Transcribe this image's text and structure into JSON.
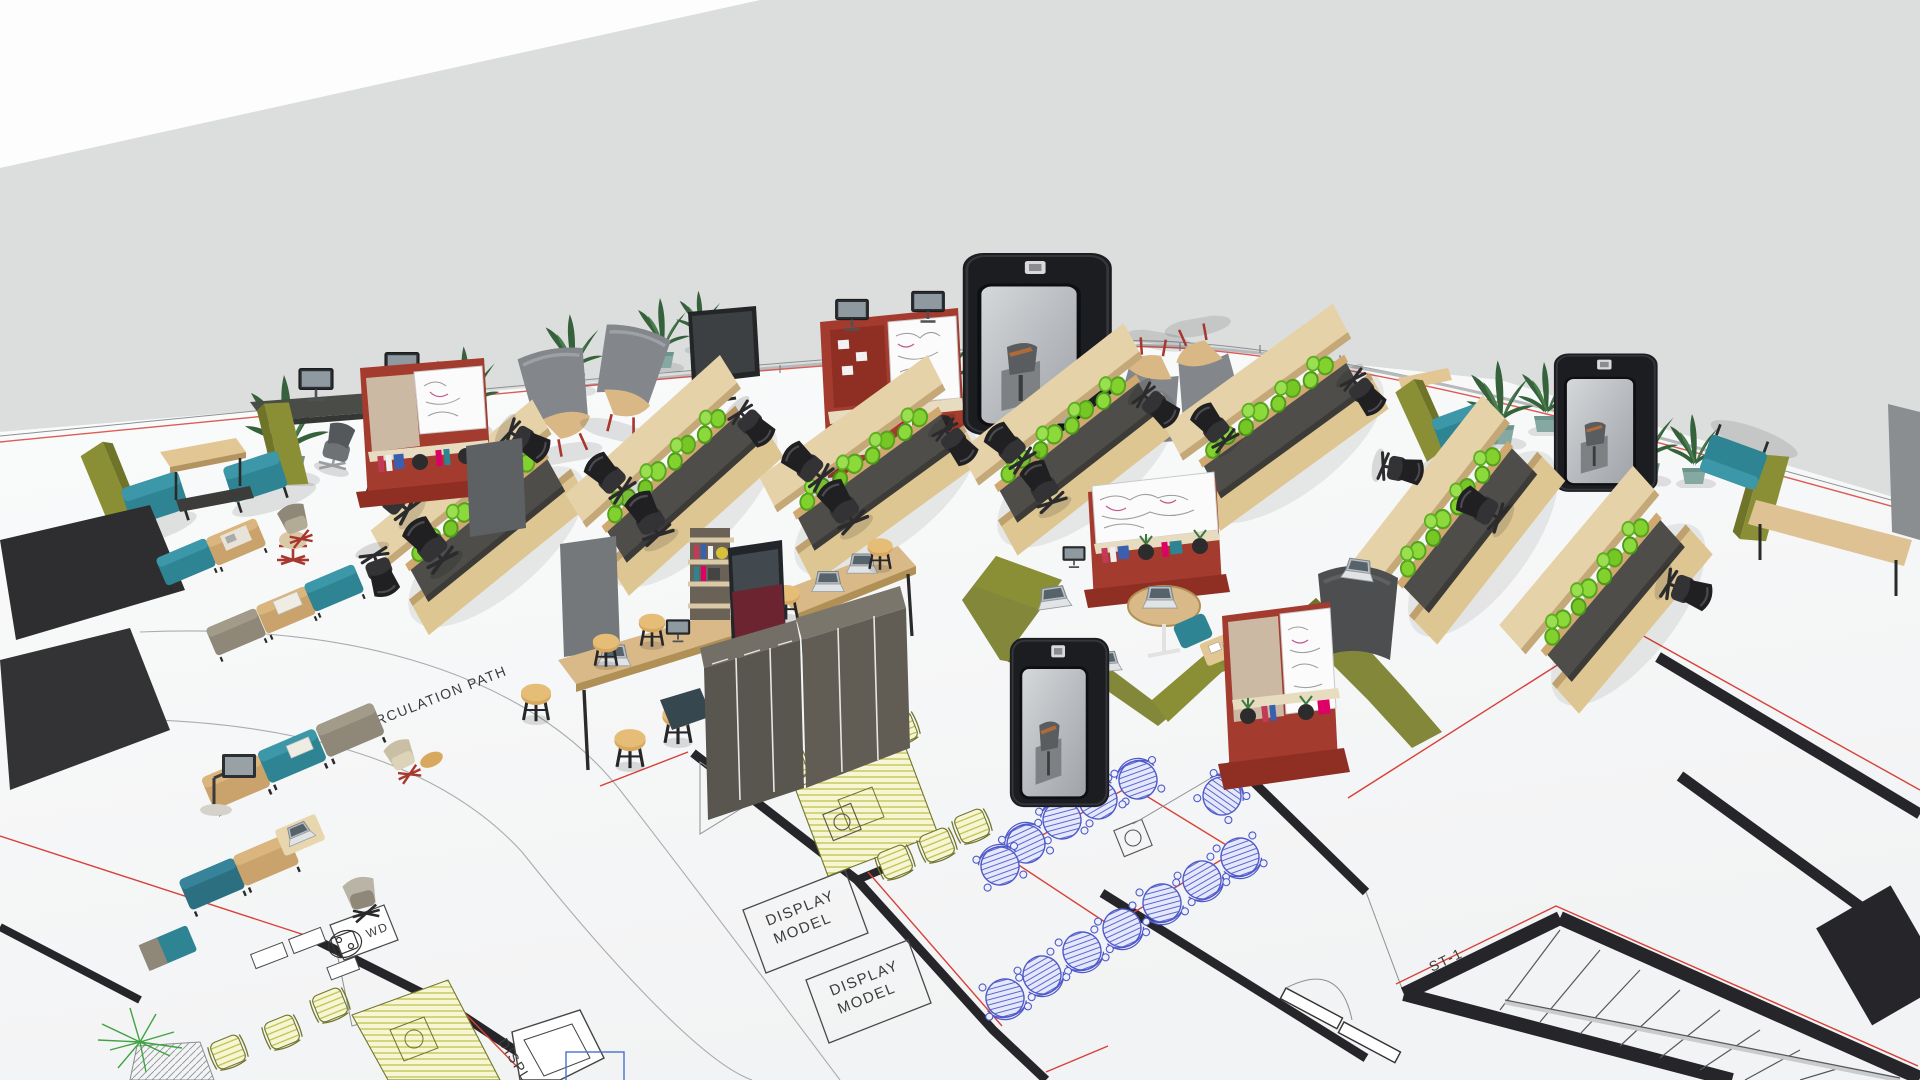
{
  "scene": {
    "description": "Aerial 3D render of an office furniture showroom floor over a 2D CAD plan",
    "labels": {
      "circulation_path": "CIRCULATION PATH",
      "display_word": "DISPLAY",
      "model_word": "MODEL",
      "stair_label": "ST-1",
      "wd_label": "WD",
      "display_partial": "DISPLAY"
    },
    "colors": {
      "slab_gray": "#dcdddd",
      "floor_white": "#f7f8f8",
      "cad_wall_black": "#26262a",
      "cad_red": "#d84038",
      "cad_blue": "#5b67cf",
      "cad_yellow_hatch": "#b9bf46",
      "accent_red_shelf": "#a33b2e",
      "wood_tan": "#d9bc8d",
      "planter_green": "#82d12f",
      "olive_upholstery": "#8a8f36",
      "teal_upholstery": "#2f8494",
      "teal_pot": "#86a8a2",
      "booth_black": "#1c1d21",
      "cabinet_gray": "#5b5852",
      "chair_black": "#2a2a2d"
    },
    "objects": {
      "phone_booths": 3,
      "red_whiteboard_units": 4,
      "workstation_clusters_with_planters": 7,
      "plan_blue_chairs": 13,
      "plan_yellow_chairs_lower_left": 3,
      "plan_yellow_chairs_right_room": 5,
      "display_model_boxes": 2
    }
  }
}
